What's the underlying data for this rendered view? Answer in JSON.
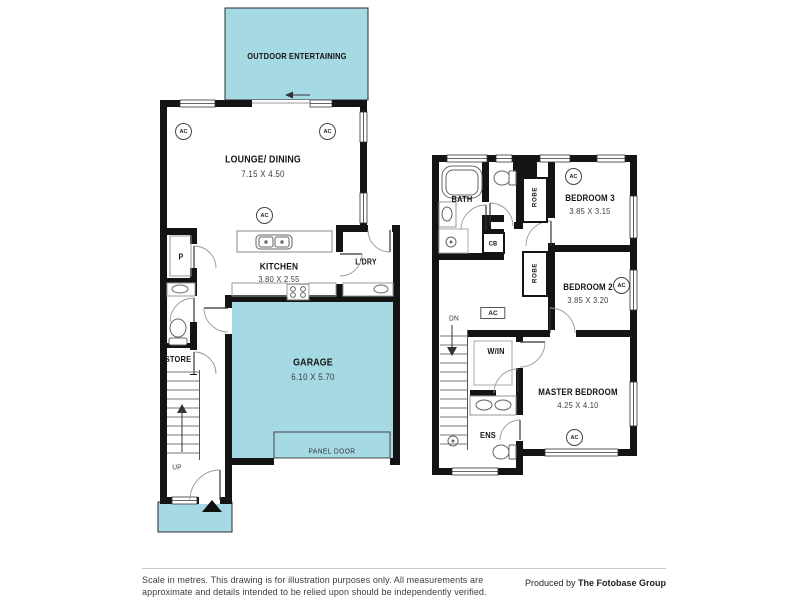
{
  "colors": {
    "highlight": "#a5d9e4",
    "wall": "#141414"
  },
  "ac_label": "AC",
  "ground_floor": {
    "outdoor": {
      "label": "OUTDOOR ENTERTAINING"
    },
    "lounge_dining": {
      "label": "LOUNGE/ DINING",
      "dims": "7.15 X 4.50"
    },
    "kitchen": {
      "label": "KITCHEN",
      "dims": "3.80 X 2.55"
    },
    "laundry": {
      "label": "L'DRY"
    },
    "pantry": {
      "label": "P"
    },
    "store": {
      "label": "STORE"
    },
    "stairs": {
      "label": "UP"
    },
    "garage": {
      "label": "GARAGE",
      "dims": "6.10 X 5.70",
      "panel_door": "PANEL DOOR"
    }
  },
  "upper_floor": {
    "bath": {
      "label": "BATH"
    },
    "robe3": {
      "label": "ROBE"
    },
    "bedroom3": {
      "label": "BEDROOM 3",
      "dims": "3.85 X 3.15"
    },
    "cupboard": {
      "label": "CB"
    },
    "robe2": {
      "label": "ROBE"
    },
    "bedroom2": {
      "label": "BEDROOM 2",
      "dims": "3.85 X 3.20"
    },
    "stairs": {
      "label": "DN"
    },
    "walk_in": {
      "label": "W/IN"
    },
    "ensuite": {
      "label": "ENS"
    },
    "master": {
      "label": "MASTER BEDROOM",
      "dims": "4.25 X 4.10"
    }
  },
  "footer": {
    "disclaimer_line1": "Scale in metres. This drawing is for illustration purposes only. All measurements are",
    "disclaimer_line2": "approximate and details intended to be relied upon should be independently verified.",
    "produced_prefix": "Produced by ",
    "produced_brand": "The Fotobase Group"
  }
}
